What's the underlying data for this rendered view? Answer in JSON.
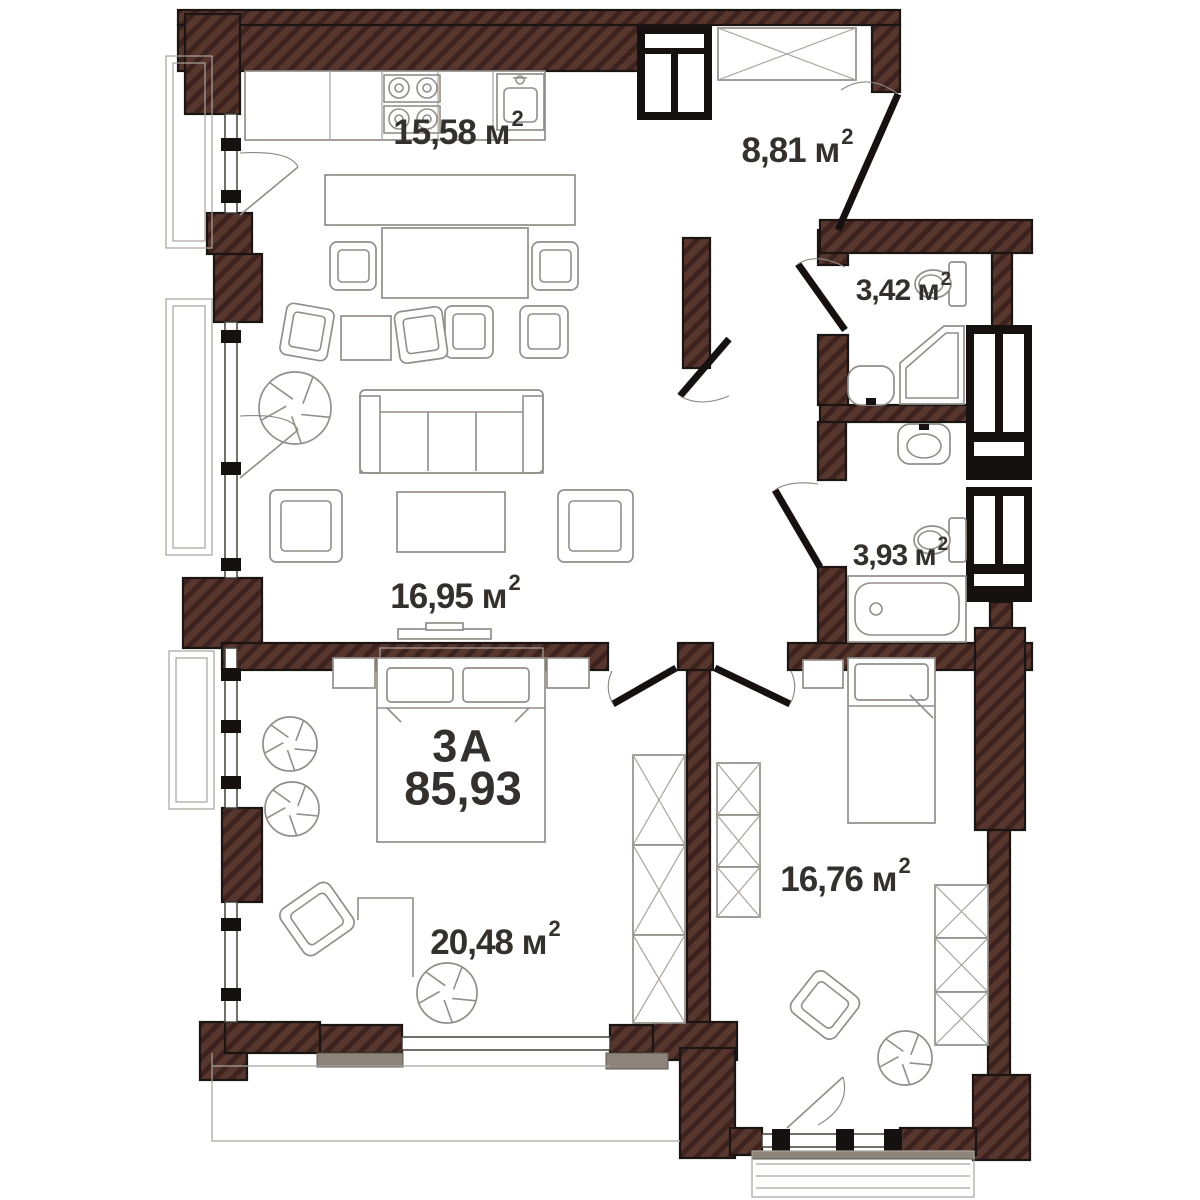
{
  "unit": {
    "name": "3А",
    "area": "85,93"
  },
  "rooms": [
    {
      "id": "kitchen-dining",
      "label": "15,58 м",
      "sup": "2"
    },
    {
      "id": "hallway",
      "label": "8,81 м",
      "sup": "2"
    },
    {
      "id": "bathroom-small",
      "label": "3,42 м",
      "sup": "2"
    },
    {
      "id": "bathroom-large",
      "label": "3,93 м",
      "sup": "2"
    },
    {
      "id": "living-area",
      "label": "16,95 м",
      "sup": "2"
    },
    {
      "id": "bedroom-1",
      "label": "20,48 м",
      "sup": "2"
    },
    {
      "id": "bedroom-2",
      "label": "16,76 м",
      "sup": "2"
    }
  ],
  "colors": {
    "wall": "#57362e",
    "hatch": "#3e221d",
    "outline": "#1a1412",
    "furniture_line": "#928e89",
    "accent_black": "#151110",
    "sill": "#8d857b",
    "text": "#34302d"
  }
}
